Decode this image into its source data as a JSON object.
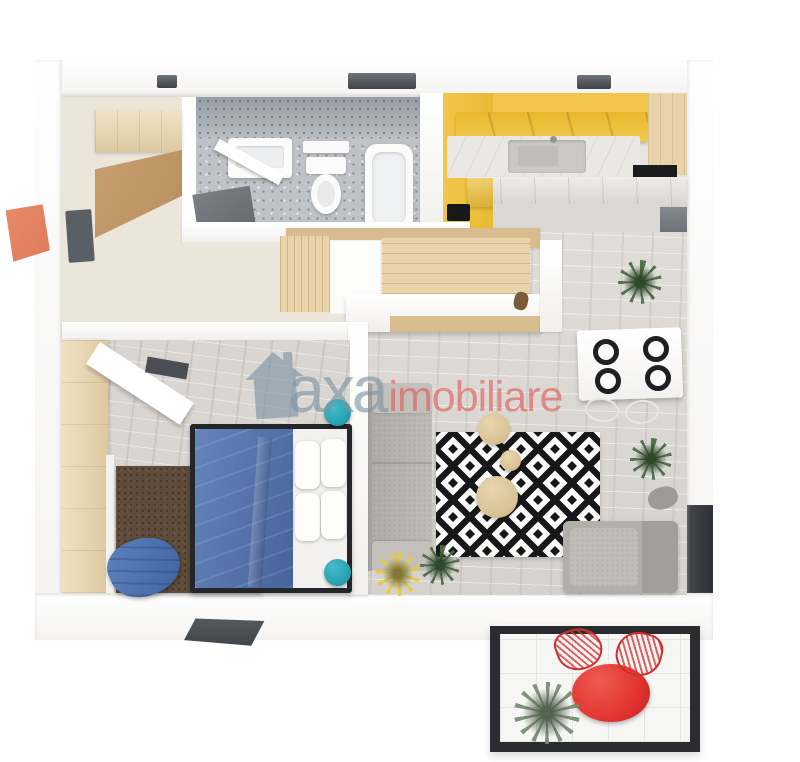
{
  "watermark": {
    "brand_primary": "axa",
    "brand_secondary": "imobiliare"
  },
  "colors": {
    "bg": "#ffffff",
    "kitchen_yellow": "#f1c64a",
    "kitchen_yellow_dark": "#e8b82b",
    "wood_light": "#e9d4a9",
    "wood_mid": "#d8bb8e",
    "wood_dark": "#c79e6e",
    "tile_gray": "#bfc3c7",
    "floor_cream": "#ebe5da",
    "floor_wood": "#dbd8d3",
    "bed_blue": "#5575ab",
    "chair_blue": "#4d72ae",
    "teal": "#2aa2b4",
    "rug_brown": "#5f4c3a",
    "sofa_gray": "#bab7b3",
    "sofa_gray_dark": "#a6a39f",
    "armchair_gray": "#b2afab",
    "mat_dark": "#5a5f66",
    "window_dark": "#53565c",
    "balcony_frame": "#2a2c30",
    "balcony_red": "#e23431",
    "plant_green": "#4d6c46",
    "plant_yellow": "#e8c93e",
    "arrow_orange": "#df7a5b",
    "table_beige": "#d9c296",
    "wm_gray": "#7d93a3",
    "wm_red": "#e05658"
  }
}
